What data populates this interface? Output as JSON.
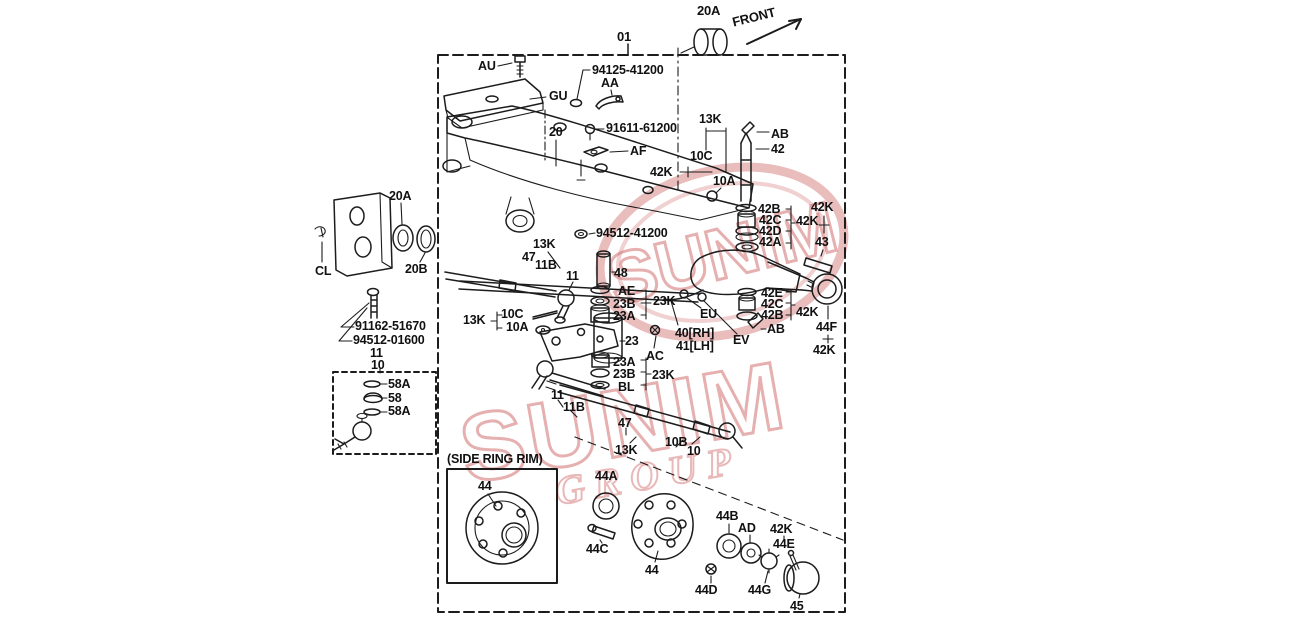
{
  "watermark": {
    "name": "SUNIM",
    "subtext": "GROUP"
  },
  "colors": {
    "line": "#1c1c1c",
    "watermark": "#ce6262"
  },
  "diagram": {
    "labels": [
      {
        "id": "ref-01",
        "t": "01",
        "x": 617,
        "y": 30,
        "fs": 13
      },
      {
        "id": "ref-20a-top",
        "t": "20A",
        "x": 697,
        "y": 4,
        "fs": 13
      },
      {
        "id": "front",
        "t": "FRONT",
        "x": 731,
        "y": 16,
        "fs": 13,
        "rot": -14
      },
      {
        "id": "au",
        "t": "AU",
        "x": 478,
        "y": 60
      },
      {
        "id": "pn-94125-41200",
        "t": "94125-41200",
        "x": 592,
        "y": 64
      },
      {
        "id": "aa",
        "t": "AA",
        "x": 601,
        "y": 77
      },
      {
        "id": "gu",
        "t": "GU",
        "x": 549,
        "y": 90
      },
      {
        "id": "n20",
        "t": "20",
        "x": 549,
        "y": 126
      },
      {
        "id": "pn-91611-61200",
        "t": "91611-61200",
        "x": 606,
        "y": 122
      },
      {
        "id": "af",
        "t": "AF",
        "x": 630,
        "y": 145
      },
      {
        "id": "k13-a",
        "t": "13K",
        "x": 699,
        "y": 113
      },
      {
        "id": "c10-a",
        "t": "10C",
        "x": 690,
        "y": 150
      },
      {
        "id": "k42-a",
        "t": "42K",
        "x": 650,
        "y": 166
      },
      {
        "id": "a10-a",
        "t": "10A",
        "x": 713,
        "y": 175
      },
      {
        "id": "ab-a",
        "t": "AB",
        "x": 771,
        "y": 128
      },
      {
        "id": "n42",
        "t": "42",
        "x": 771,
        "y": 143
      },
      {
        "id": "a20-left",
        "t": "20A",
        "x": 389,
        "y": 190
      },
      {
        "id": "b20",
        "t": "20B",
        "x": 405,
        "y": 263
      },
      {
        "id": "cl",
        "t": "CL",
        "x": 315,
        "y": 265
      },
      {
        "id": "pn-91162-51670",
        "t": "91162-51670",
        "x": 355,
        "y": 320
      },
      {
        "id": "pn-94512-01600",
        "t": "94512-01600",
        "x": 353,
        "y": 334
      },
      {
        "id": "n11-left",
        "t": "11",
        "x": 370,
        "y": 347
      },
      {
        "id": "n10-left",
        "t": "10",
        "x": 371,
        "y": 359
      },
      {
        "id": "a58-1",
        "t": "58A",
        "x": 388,
        "y": 378
      },
      {
        "id": "n58",
        "t": "58",
        "x": 388,
        "y": 392
      },
      {
        "id": "a58-2",
        "t": "58A",
        "x": 388,
        "y": 405
      },
      {
        "id": "pn-94512-41200",
        "t": "94512-41200",
        "x": 596,
        "y": 227
      },
      {
        "id": "k13-b",
        "t": "13K",
        "x": 533,
        "y": 238
      },
      {
        "id": "n47-b",
        "t": "47",
        "x": 522,
        "y": 251
      },
      {
        "id": "b11-b",
        "t": "11B",
        "x": 535,
        "y": 259
      },
      {
        "id": "n11-b",
        "t": "11",
        "x": 566,
        "y": 270
      },
      {
        "id": "n48",
        "t": "48",
        "x": 614,
        "y": 267
      },
      {
        "id": "ae",
        "t": "AE",
        "x": 618,
        "y": 285
      },
      {
        "id": "b23-u",
        "t": "23B",
        "x": 613,
        "y": 298
      },
      {
        "id": "a23-u",
        "t": "23A",
        "x": 613,
        "y": 310
      },
      {
        "id": "k23-u",
        "t": "23K",
        "x": 653,
        "y": 295
      },
      {
        "id": "k13-c",
        "t": "13K",
        "x": 463,
        "y": 314
      },
      {
        "id": "c10-c",
        "t": "10C",
        "x": 501,
        "y": 308
      },
      {
        "id": "a10-c",
        "t": "10A",
        "x": 506,
        "y": 321
      },
      {
        "id": "n23",
        "t": "23",
        "x": 625,
        "y": 335
      },
      {
        "id": "ac",
        "t": "AC",
        "x": 646,
        "y": 350
      },
      {
        "id": "eu",
        "t": "EU",
        "x": 700,
        "y": 308
      },
      {
        "id": "rh40",
        "t": "40[RH]",
        "x": 675,
        "y": 327
      },
      {
        "id": "lh41",
        "t": "41[LH]",
        "x": 676,
        "y": 340
      },
      {
        "id": "ev",
        "t": "EV",
        "x": 733,
        "y": 334
      },
      {
        "id": "b42-u",
        "t": "42B",
        "x": 758,
        "y": 203
      },
      {
        "id": "c42-u",
        "t": "42C",
        "x": 759,
        "y": 214
      },
      {
        "id": "d42",
        "t": "42D",
        "x": 759,
        "y": 225
      },
      {
        "id": "a42",
        "t": "42A",
        "x": 759,
        "y": 236
      },
      {
        "id": "k42-u1",
        "t": "42K",
        "x": 796,
        "y": 215
      },
      {
        "id": "k42-u2",
        "t": "42K",
        "x": 811,
        "y": 201
      },
      {
        "id": "n43",
        "t": "43",
        "x": 815,
        "y": 236
      },
      {
        "id": "e42",
        "t": "42E",
        "x": 761,
        "y": 287
      },
      {
        "id": "c42-l",
        "t": "42C",
        "x": 761,
        "y": 298
      },
      {
        "id": "b42-l",
        "t": "42B",
        "x": 761,
        "y": 309
      },
      {
        "id": "k42-l",
        "t": "42K",
        "x": 796,
        "y": 306
      },
      {
        "id": "ab-b",
        "t": "AB",
        "x": 767,
        "y": 323
      },
      {
        "id": "f44",
        "t": "44F",
        "x": 816,
        "y": 321
      },
      {
        "id": "k42-f",
        "t": "42K",
        "x": 813,
        "y": 344
      },
      {
        "id": "a23-l",
        "t": "23A",
        "x": 613,
        "y": 356
      },
      {
        "id": "b23-l",
        "t": "23B",
        "x": 613,
        "y": 368
      },
      {
        "id": "bl",
        "t": "BL",
        "x": 618,
        "y": 381
      },
      {
        "id": "k23-l",
        "t": "23K",
        "x": 652,
        "y": 369
      },
      {
        "id": "n11-c",
        "t": "11",
        "x": 551,
        "y": 389
      },
      {
        "id": "b11-c",
        "t": "11B",
        "x": 563,
        "y": 401
      },
      {
        "id": "n47-c",
        "t": "47",
        "x": 618,
        "y": 417
      },
      {
        "id": "k13-d",
        "t": "13K",
        "x": 615,
        "y": 444
      },
      {
        "id": "b10",
        "t": "10B",
        "x": 665,
        "y": 436
      },
      {
        "id": "n10-b",
        "t": "10",
        "x": 687,
        "y": 445
      },
      {
        "id": "srr",
        "t": "(SIDE RING RIM)",
        "x": 447,
        "y": 453
      },
      {
        "id": "n44-box",
        "t": "44",
        "x": 478,
        "y": 480
      },
      {
        "id": "a44",
        "t": "44A",
        "x": 595,
        "y": 470
      },
      {
        "id": "c44",
        "t": "44C",
        "x": 586,
        "y": 543
      },
      {
        "id": "n44-hub",
        "t": "44",
        "x": 645,
        "y": 564
      },
      {
        "id": "b44",
        "t": "44B",
        "x": 716,
        "y": 510
      },
      {
        "id": "ad",
        "t": "AD",
        "x": 738,
        "y": 522
      },
      {
        "id": "k42-b",
        "t": "42K",
        "x": 770,
        "y": 523
      },
      {
        "id": "e44",
        "t": "44E",
        "x": 773,
        "y": 538
      },
      {
        "id": "d44",
        "t": "44D",
        "x": 695,
        "y": 584
      },
      {
        "id": "g44",
        "t": "44G",
        "x": 748,
        "y": 584
      },
      {
        "id": "n45",
        "t": "45",
        "x": 790,
        "y": 600
      }
    ]
  }
}
